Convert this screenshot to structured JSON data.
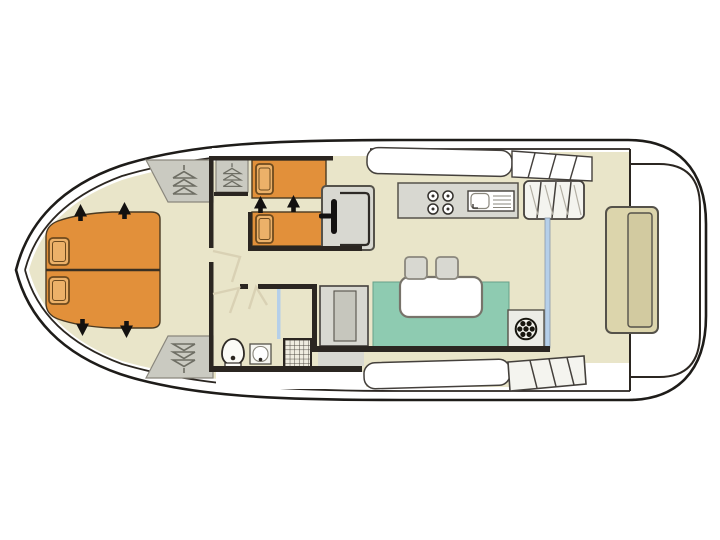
{
  "page": {
    "canvas_width": 720,
    "canvas_height": 540,
    "background": "#ffffff"
  },
  "plan": {
    "kind": "houseboat-deck-plan",
    "orientation": "bow-left",
    "areas": {
      "bow_cabin": "double-berth-cabin",
      "twin_cabin": "twin-berth-cabin",
      "corridor": "corridor-with-doors",
      "bathroom": "bathroom",
      "galley": "galley",
      "helm": "inner-steering-position",
      "saloon": "saloon-dinette",
      "aft_deck": "aft-deck-with-bench",
      "side_decks": "side-decks-with-steps"
    },
    "icons": {
      "hanger": "wardrobe-hangers-icon",
      "wheel": "helm-wheel-icon",
      "arrow": "bed-extension-arrow-icon",
      "burner": "stove-burner-icon",
      "shower": "shower-grid-icon"
    },
    "counts": {
      "bow_pillows": 2,
      "twin_beds": 2,
      "stove_burners": 4,
      "stools": 2,
      "extension_arrows": 6,
      "wardrobes": 3
    }
  },
  "colors": {
    "white": "#ffffff",
    "floor_beige": "#e9e5c9",
    "bed_orange": "#e2903a",
    "pillow_tan": "#ecb169",
    "sofa_green": "#8ecbb1",
    "furniture_gray": "#d8d8d1",
    "furniture_gray_dark": "#c6c6bd",
    "wardrobe_gray": "#cacac1",
    "wall_dark": "#2b2621",
    "bench_tan": "#dcd5ac",
    "bench_inner": "#d2caa0",
    "glass_blue": "#b5cfe9",
    "arrow_black": "#131110",
    "door_swing": "#d9d1b4",
    "hanger_gray": "#6e6e64",
    "steps_white": "#f4f4ef",
    "shower_bg": "#efece0",
    "wheel_black": "#18160f"
  }
}
